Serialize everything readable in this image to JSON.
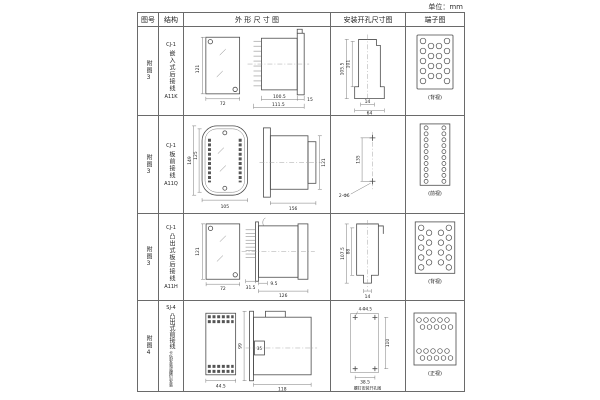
{
  "page": {
    "unit_label": "单位：mm"
  },
  "table": {
    "headers": [
      "图号",
      "结构",
      "外 形 尺 寸 图",
      "安装开孔尺寸图",
      "端子图"
    ],
    "rows": [
      {
        "fig": "附图3",
        "model": "CJ-1",
        "struct": "嵌入式后接线",
        "code": "A11K",
        "outline": {
          "front_h": "121",
          "front_w": "72",
          "side_a": "100.5",
          "side_b": "111.5",
          "side_c": "15"
        },
        "mounting": {
          "v1": "105.5",
          "v2": "101",
          "b1": "14",
          "b2": "64"
        },
        "terminal": {
          "caption": "(背视)"
        }
      },
      {
        "fig": "附图3",
        "model": "CJ-1",
        "struct": "板前接线",
        "code": "A11Q",
        "outline": {
          "front_h1": "149",
          "front_h2": "125",
          "front_w": "105",
          "side_w": "156",
          "side_h": "121"
        },
        "mounting": {
          "v": "135",
          "hole": "2-Φ6"
        },
        "terminal": {
          "caption": "(前视)"
        }
      },
      {
        "fig": "附图3",
        "model": "CJ-1",
        "struct": "凸出式板后接线",
        "code": "A11H",
        "outline": {
          "front_h": "121",
          "front_w": "72",
          "side_a": "31.5",
          "side_b": "9.5",
          "side_c": "126"
        },
        "mounting": {
          "v1": "107.5",
          "v2": "88",
          "b1": "14"
        },
        "terminal": {
          "caption": "(背视)"
        }
      },
      {
        "fig": "附图4",
        "model": "SJ-4",
        "struct": "凸出式前接线",
        "note": "卡轨安装或螺钉安装",
        "outline": {
          "front_w": "44.5",
          "rail": "35",
          "side_h": "99",
          "side_w": "118"
        },
        "mounting": {
          "hole": "4-Φ4.5",
          "v": "110",
          "b": "38.5",
          "caption": "螺钉安装开孔图"
        },
        "terminal": {
          "caption": "(正视)"
        }
      }
    ]
  }
}
